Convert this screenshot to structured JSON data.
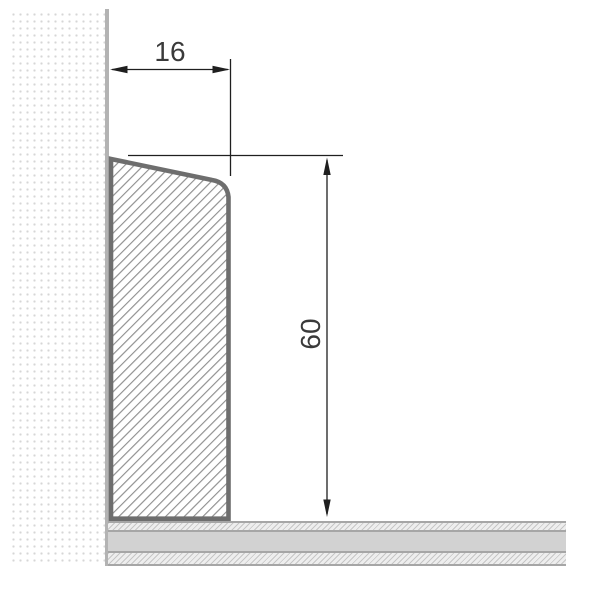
{
  "drawing": {
    "kind": "technical-cross-section",
    "subject": "skirting-board-profile-on-wall-and-floor",
    "dim_width": {
      "value": "16",
      "orientation": "horizontal"
    },
    "dim_height": {
      "value": "60",
      "orientation": "vertical"
    }
  },
  "colors": {
    "background": "#ffffff",
    "wall_dots": "#d6d6d6",
    "wall_edge": "#b3b3b3",
    "profile_outline": "#6e6e6e",
    "profile_hatch": "#8f8f8f",
    "floor_border": "#a6a6a6",
    "floor_solid": "#d2d2d2",
    "floor_hatch": "#c6c6c6",
    "dimension_line": "#1f1f1f",
    "dimension_text": "#3a3a3a"
  }
}
